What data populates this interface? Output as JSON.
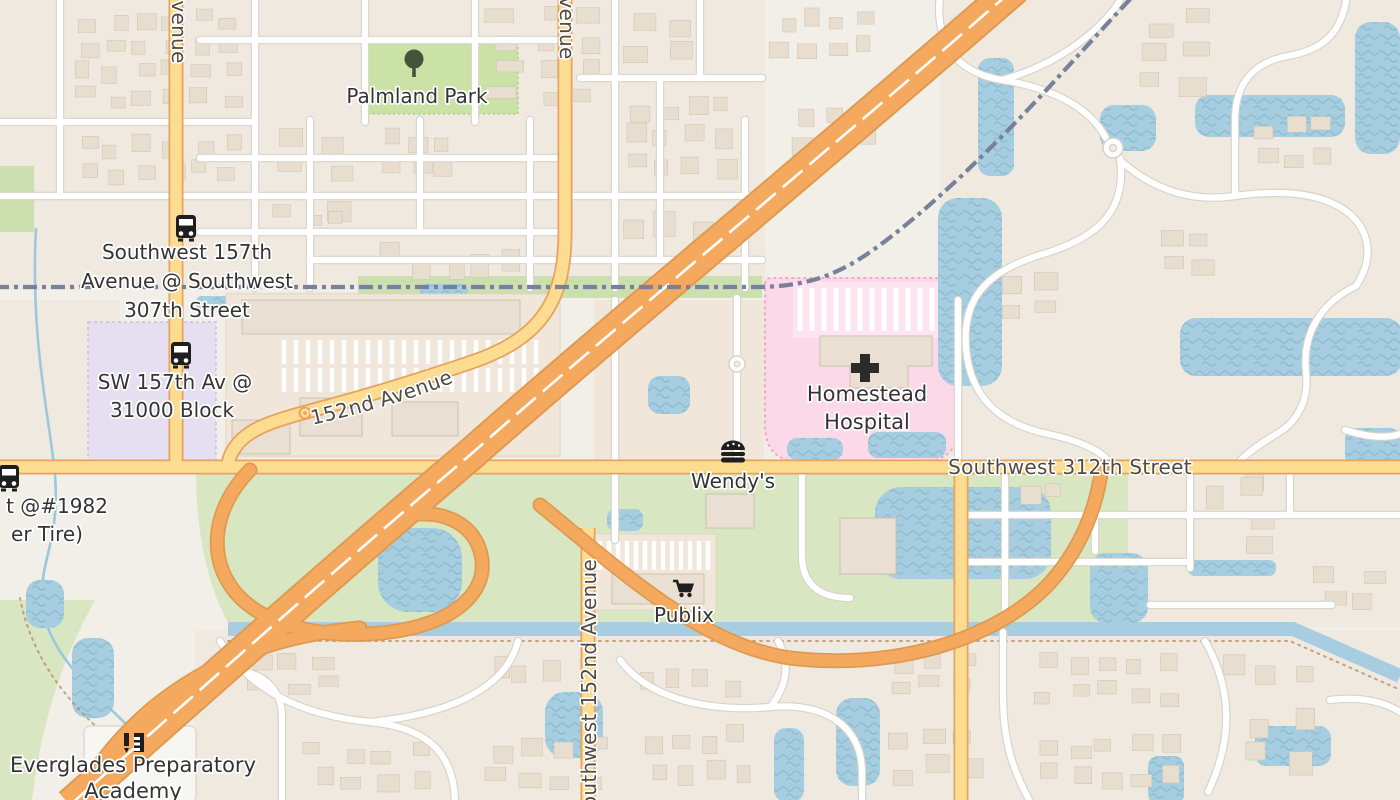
{
  "labels": {
    "park": "Palmland Park",
    "hospital": [
      "Homestead",
      "Hospital"
    ],
    "wendys": "Wendy's",
    "publix": "Publix",
    "academy": [
      "Everglades Preparatory",
      "Academy"
    ],
    "roads": {
      "sw_312th": "Southwest 312th Street",
      "sw_152nd_curved": "Southwest 152nd Avenue",
      "sw_152nd_south": "Southwest 152nd Avenue",
      "avenue_west_partial": "venue",
      "avenue_mid_partial": "venue"
    },
    "bus_stops": {
      "sw157_at_307": [
        "Southwest 157th",
        "Avenue @ Southwest",
        "307th Street"
      ],
      "sw157_31000": [
        "SW 157th Av @",
        "31000 Block"
      ],
      "tire_partial": [
        "t @#1982",
        "er Tire)"
      ]
    }
  },
  "icons": {
    "bus": "bus-icon",
    "tree": "tree-icon",
    "hospital_cross": "hospital-cross-icon",
    "burger": "burger-icon",
    "cart": "shopping-cart-icon",
    "school": "school-icon"
  },
  "colors": {
    "land": "#F2EFE8",
    "water": "#A6CEE0",
    "park": "#CBE2A6",
    "grass": "#D8E6C2",
    "hospital_pink": "#FBD9E9",
    "school_purple": "#E6DFF2",
    "primary_road": "#FBDC91",
    "motorway": "#F5A95F",
    "railway": "#77819C",
    "label_dark": "#343434",
    "label_road": "#4F4A44"
  }
}
